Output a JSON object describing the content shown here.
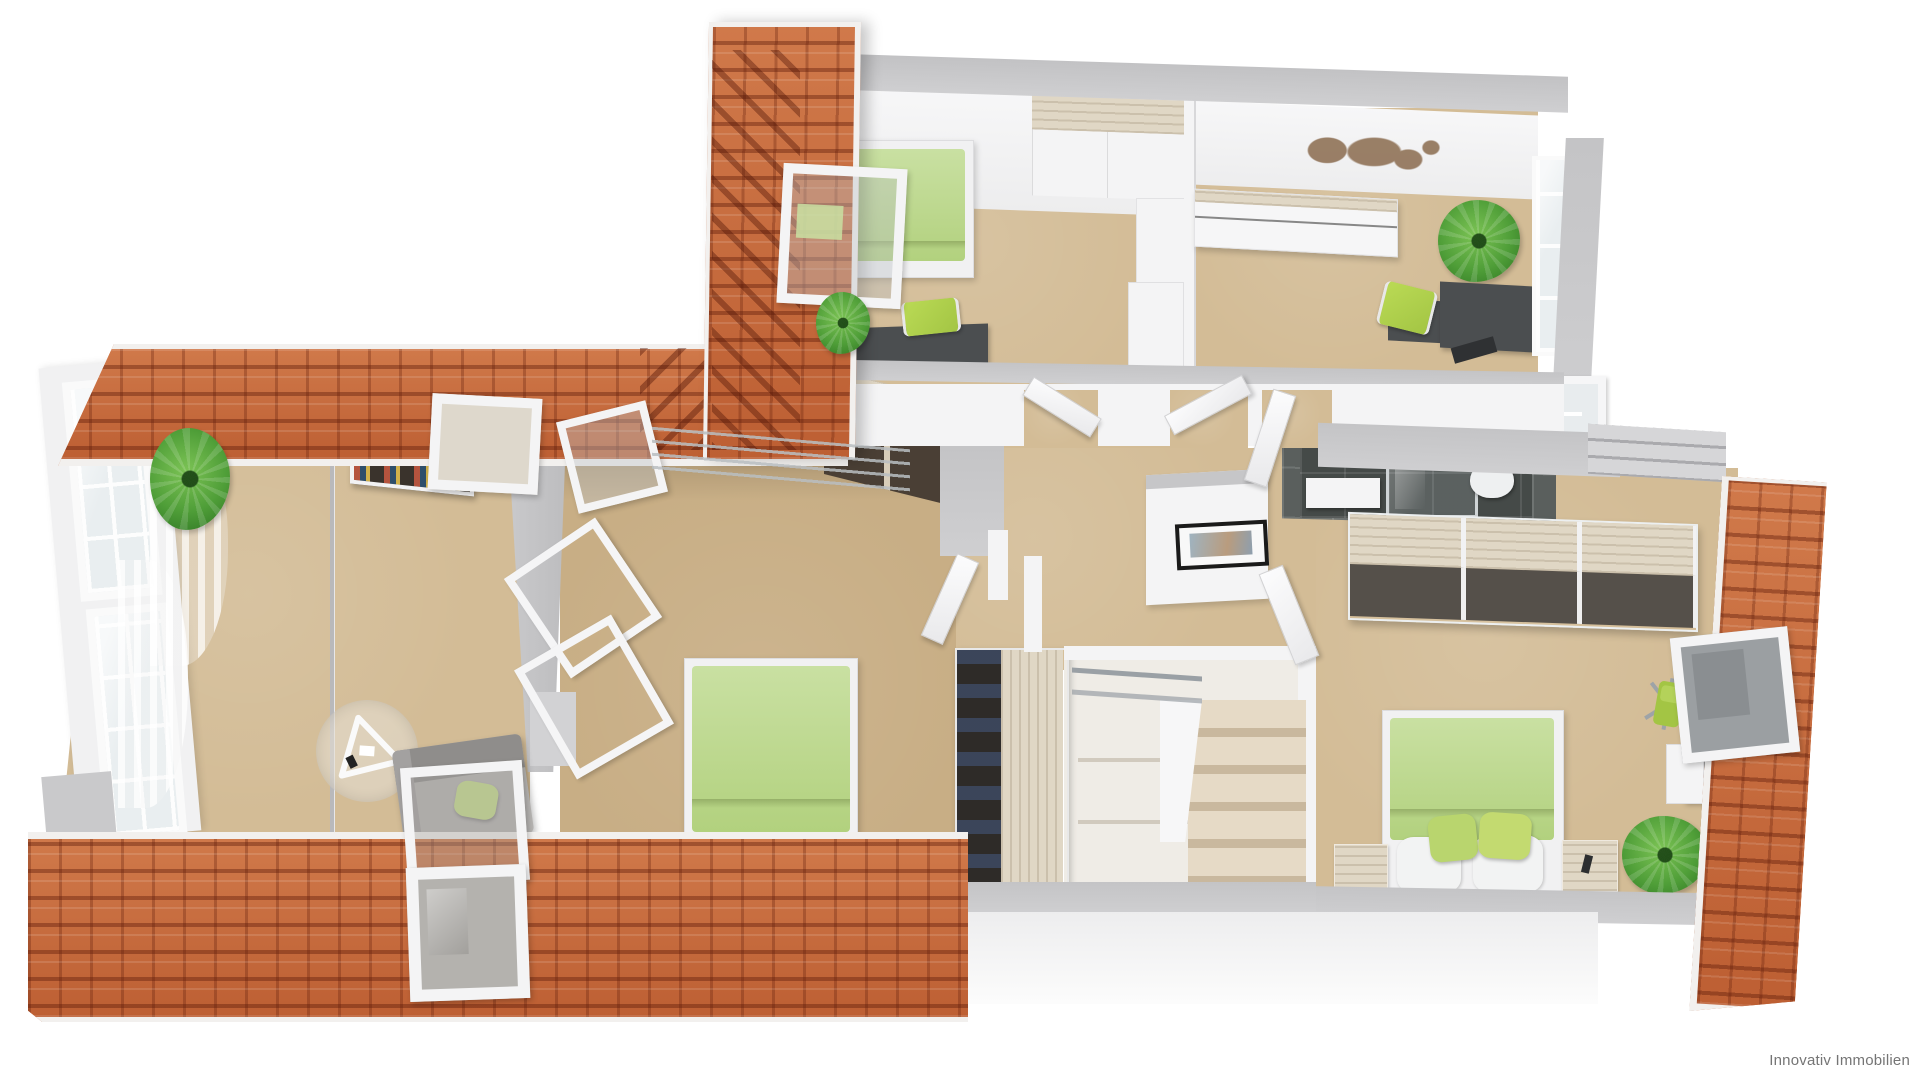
{
  "watermark": {
    "text": "Innovativ Immobilien"
  },
  "palette": {
    "page_bg": "#ffffff",
    "roof": "#c4683c",
    "roof_dark": "#8a3a1c",
    "roof_edge": "#f2f0ee",
    "floor": "#d3bc96",
    "floor_dark": "#c8ae85",
    "wall": "#c4c4c6",
    "wall_light": "#f4f4f5",
    "partition": "#b9b9bb",
    "bedding": "#c9e0a2",
    "bedding_dark": "#b2d17e",
    "pillow_green": "#b9d56e",
    "chair_green": "#a3c544",
    "plant": "#4f9e38",
    "wood": "#e0d7c5",
    "desk_dark": "#4b4e50",
    "wardrobe_interior": "#2e2b28",
    "tile": "#5a5f5d",
    "tile_dark": "#454a48",
    "glass": "#c3c8ca",
    "rail": "#9aa0a5",
    "step": "#e6dac6",
    "step_shadow": "#c9b89e",
    "art_frame": "#1a1a1a",
    "map_brown": "#8a6b4e",
    "watermark_gray": "#757575"
  }
}
